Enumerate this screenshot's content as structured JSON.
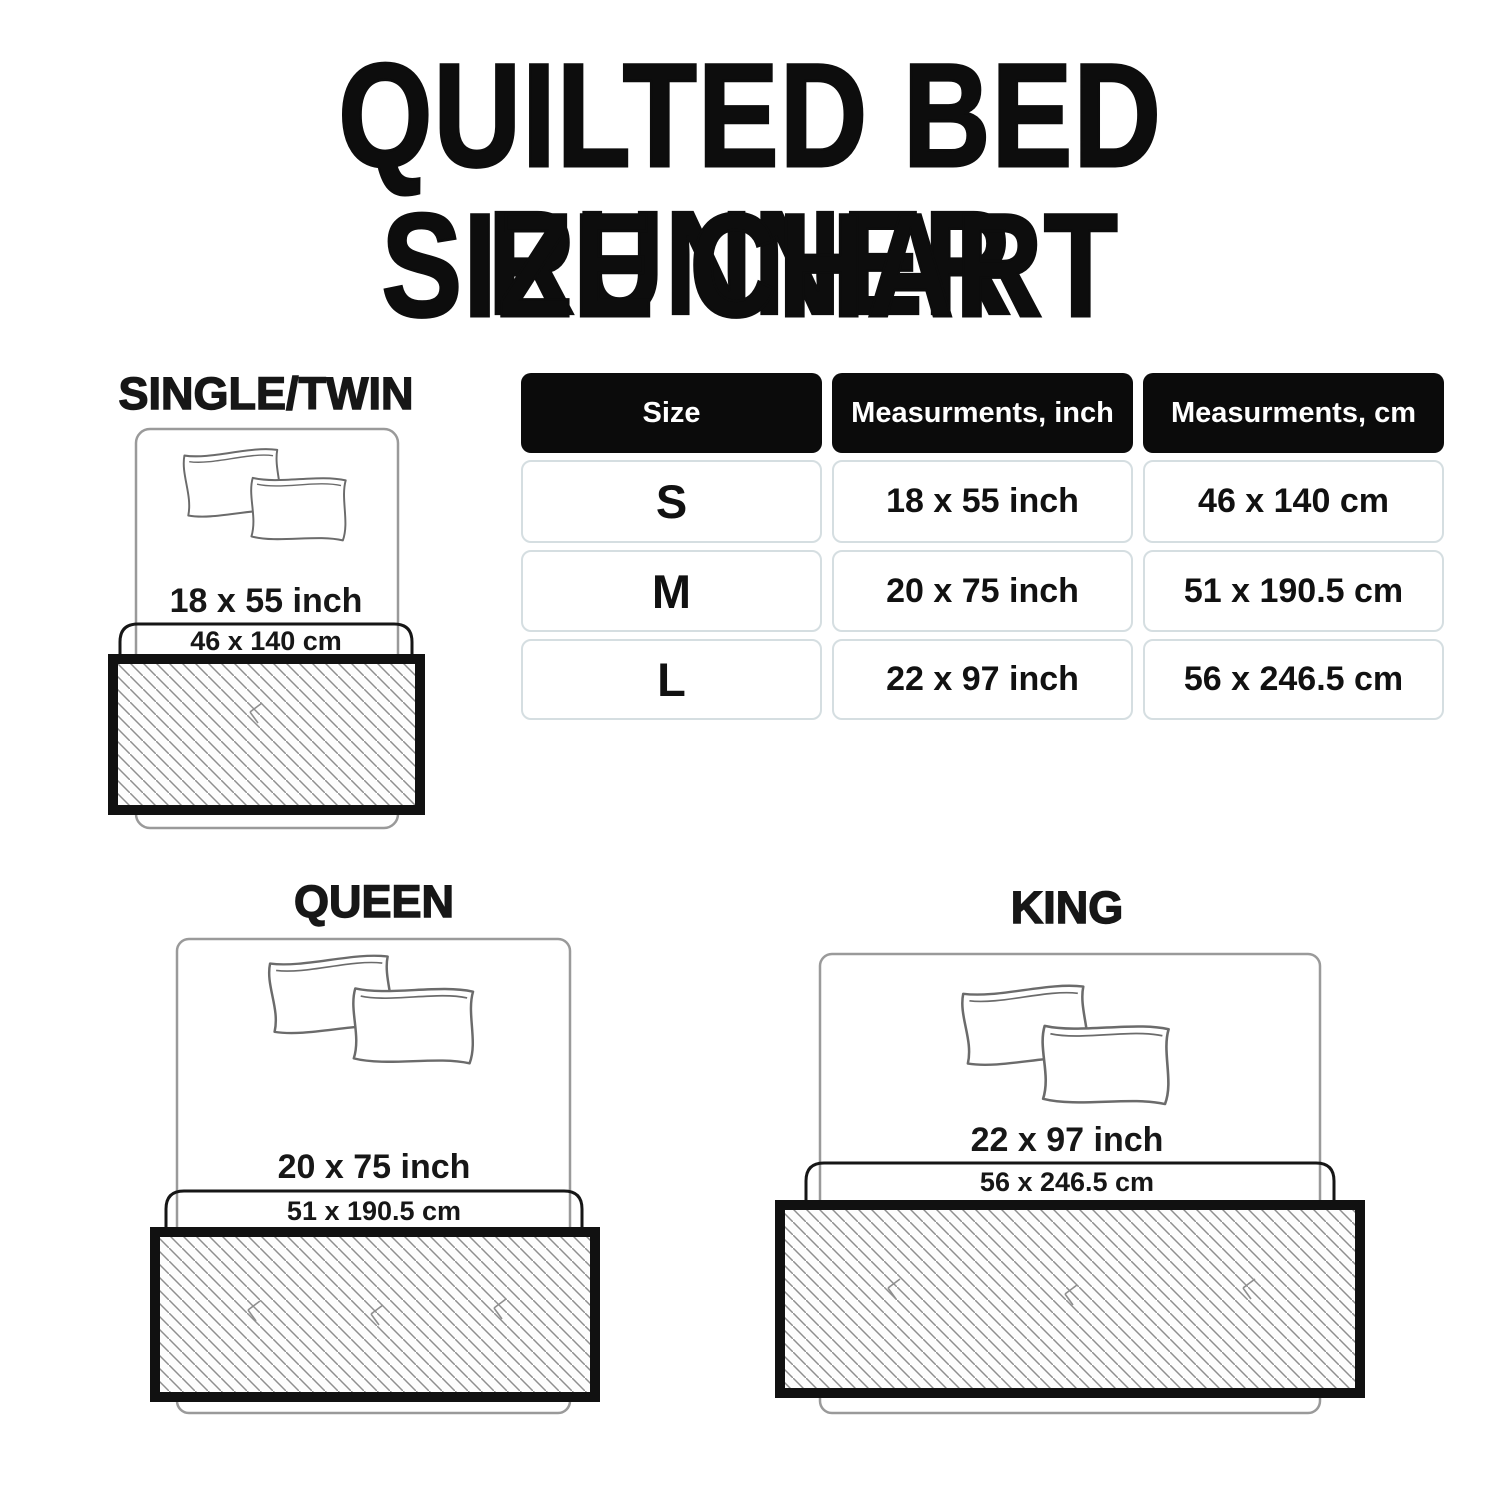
{
  "title": {
    "line1": "QUILTED BED RUNNER",
    "line2": "SIZE CHART"
  },
  "size_table": {
    "headers": [
      "Size",
      "Measurments, inch",
      "Measurments, cm"
    ],
    "rows": [
      {
        "size": "S",
        "inch": "18 x 55 inch",
        "cm": "46 x 140 cm"
      },
      {
        "size": "M",
        "inch": "20 x 75 inch",
        "cm": "51 x 190.5 cm"
      },
      {
        "size": "L",
        "inch": "22 x 97 inch",
        "cm": "56 x 246.5 cm"
      }
    ]
  },
  "diagrams": [
    {
      "name": "SINGLE/TWIN",
      "inch_label": "18 x 55 inch",
      "cm_label": "46 x 140 cm"
    },
    {
      "name": "QUEEN",
      "inch_label": "20 x 75 inch",
      "cm_label": "51 x 190.5 cm"
    },
    {
      "name": "KING",
      "inch_label": "22 x 97 inch",
      "cm_label": "56 x 246.5 cm"
    }
  ],
  "colors": {
    "text": "#1a1a1a",
    "header_bg": "#0b0b0b",
    "header_text": "#ffffff",
    "cell_border": "#d5dee1",
    "bed_outline": "#9a9a9a",
    "pillow_outline": "#6b6b6b",
    "width_box_outline": "#161616",
    "runner_frame": "#111111",
    "hatch_line": "#8f8f8f"
  }
}
